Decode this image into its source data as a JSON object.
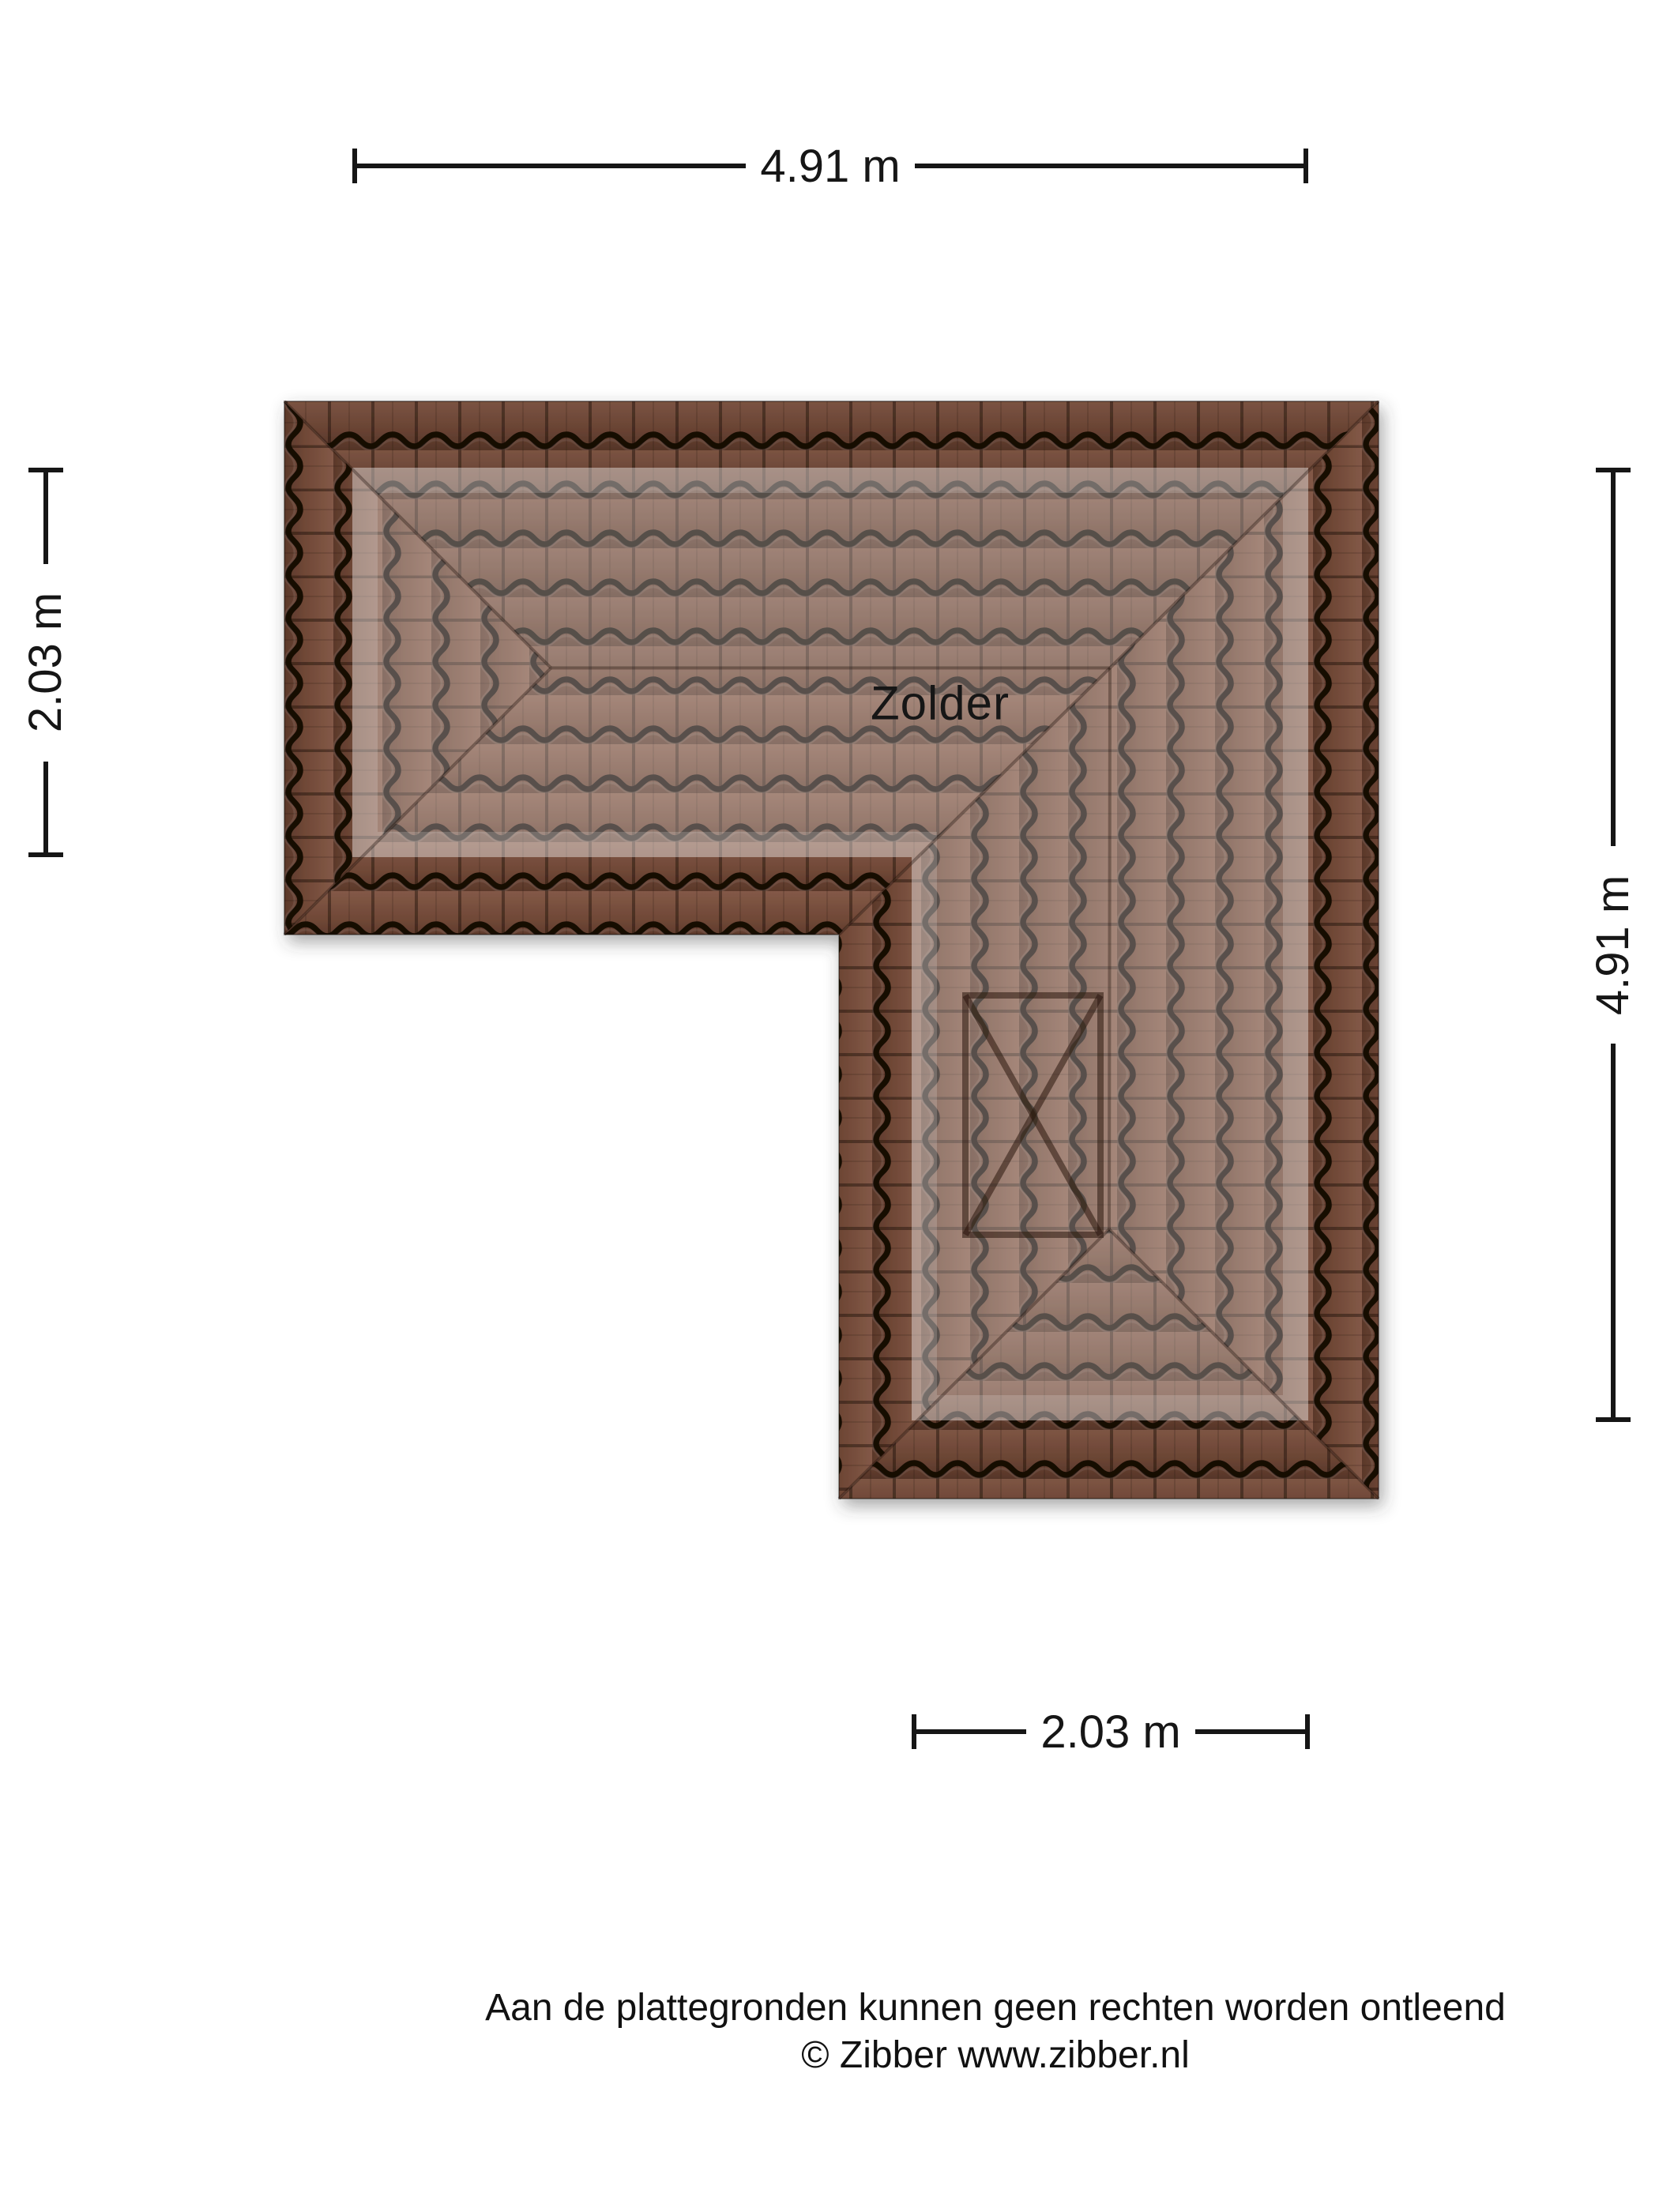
{
  "floorplan": {
    "room_label": "Zolder",
    "dimensions": {
      "top": "4.91 m",
      "left": "2.03 m",
      "right": "4.91 m",
      "bottom": "2.03 m"
    },
    "disclaimer": {
      "line1": "Aan de plattegronden kunnen geen rechten worden ontleend",
      "line2": "© Zibber www.zibber.nl"
    },
    "colors": {
      "background": "#ffffff",
      "tile_body_dark": "#6f4736",
      "tile_body_light": "#835947",
      "tile_gap": "#190d06",
      "footprint_highlight": "rgba(255,255,255,0.28)",
      "dimension_ink": "#161616"
    },
    "markers": {
      "skylight": "x-box"
    }
  }
}
